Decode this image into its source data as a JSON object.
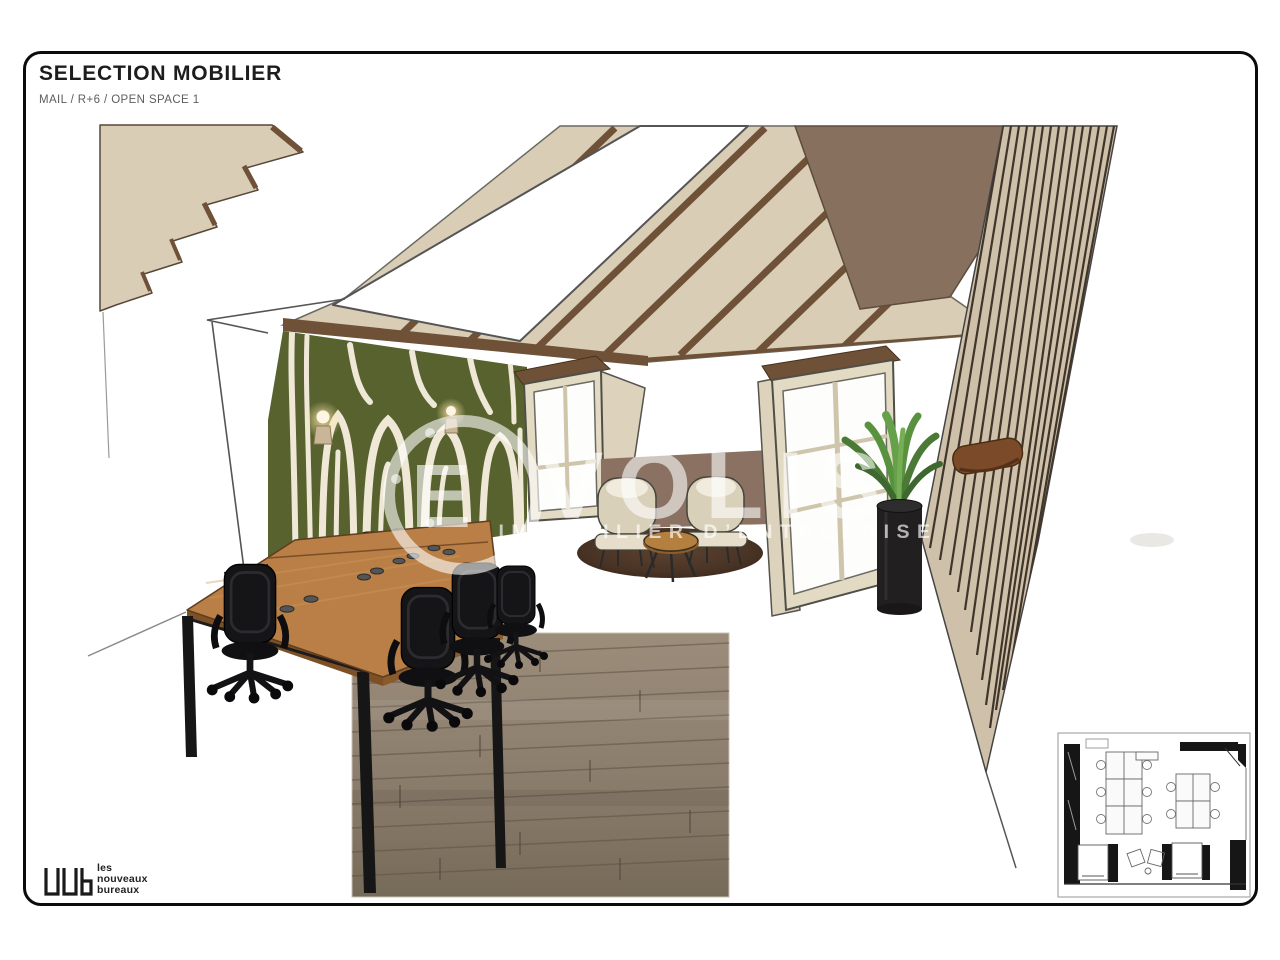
{
  "page": {
    "title": "SELECTION MOBILIER",
    "subtitle": "MAIL / R+6 / OPEN SPACE 1"
  },
  "watermark": {
    "logo_initial": "E",
    "brand_suffix": "VOLIS",
    "tagline": "IMMOBILIER D’ENTREPRISE"
  },
  "footer_logo": {
    "line1": "les",
    "line2": "nouveaux",
    "line3": "bureaux"
  },
  "colors": {
    "feature_wall_green": "#57622f",
    "feature_wall_cream": "#efe8d6",
    "mid_wall_brown": "#8a7161",
    "ceiling_beige": "#d9cdb6",
    "ceiling_dark_brown": "#87705e",
    "desk_wood": "#b97f46",
    "floor_plank": "#8d8071",
    "ink": "#161616"
  }
}
